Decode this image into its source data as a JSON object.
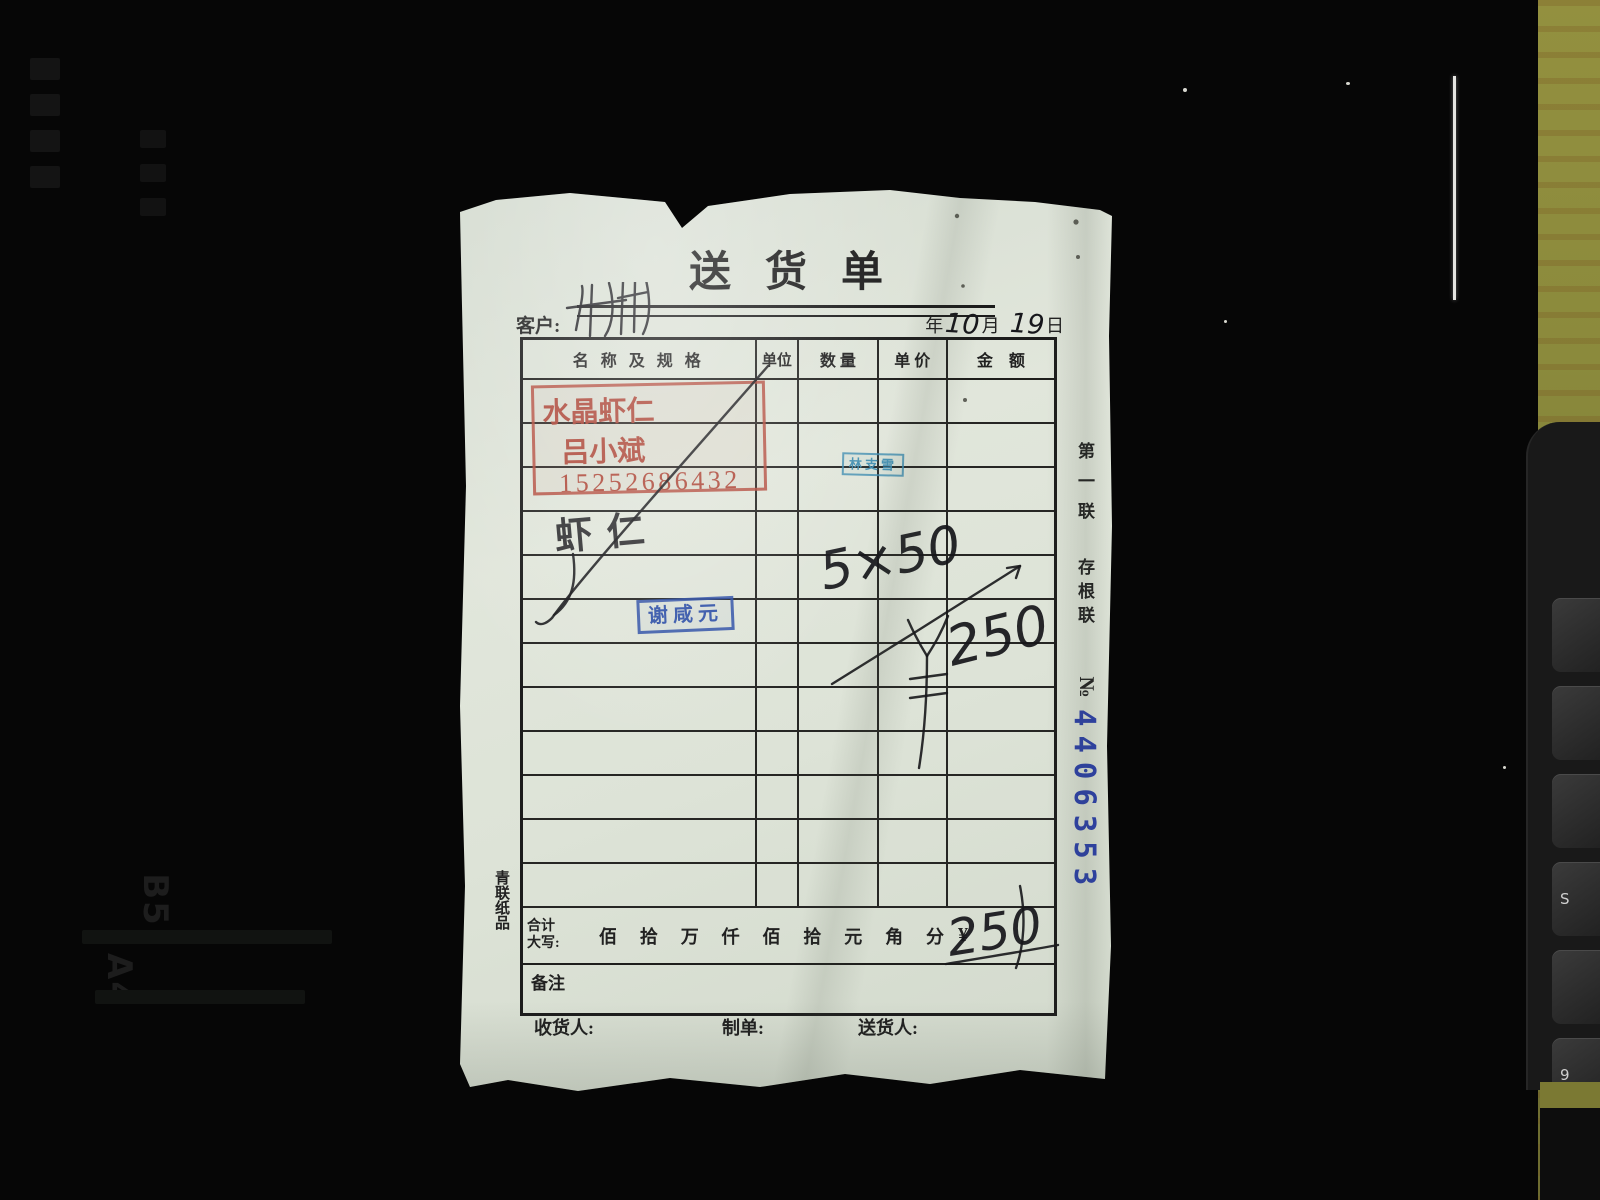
{
  "scene": {
    "background_color": "#060606",
    "wood_strip_color": "#8c8a3e",
    "copier_markings": [
      "B5",
      "A4"
    ],
    "device_key_labels": [
      "",
      "",
      "",
      "S",
      "",
      "9"
    ]
  },
  "document": {
    "title": "送货单",
    "customer_label": "客户:",
    "date": {
      "year_label": "年",
      "month_value": "10",
      "month_label": "月",
      "day_value": "19",
      "day_label": "日"
    },
    "table": {
      "headers": [
        "名 称 及 规 格",
        "单位",
        "数 量",
        "单 价",
        "金　额"
      ],
      "body_row_count": 12,
      "entry": {
        "name": "虾仁",
        "qty_calc": "5×50",
        "amount_sign": "¥",
        "amount_value": "250"
      }
    },
    "stamps": {
      "red_seller": {
        "line1": "水晶虾仁",
        "line2": "吕小斌",
        "line3": "15252686432",
        "color": "#b34a3c"
      },
      "blue_small": {
        "text": "林支雪",
        "color": "#3e8cb0"
      },
      "blue_name": {
        "text": "谢咸元",
        "color": "#2b4da6"
      }
    },
    "total_row": {
      "label1": "合计",
      "label2": "大写:",
      "units": [
        "佰",
        "拾",
        "万",
        "仟",
        "佰",
        "拾",
        "元",
        "角",
        "分"
      ],
      "currency_sign": "¥",
      "handwritten_total": "250"
    },
    "remark_label": "备注",
    "footer": {
      "receiver": "收货人:",
      "maker": "制单:",
      "deliverer": "送货人:"
    },
    "printer_mark": "青联纸品",
    "stub": {
      "copy": "第一联",
      "root": "存根联",
      "no_sign": "№",
      "serial": "4406353",
      "serial_color": "#2b3fa8"
    }
  }
}
